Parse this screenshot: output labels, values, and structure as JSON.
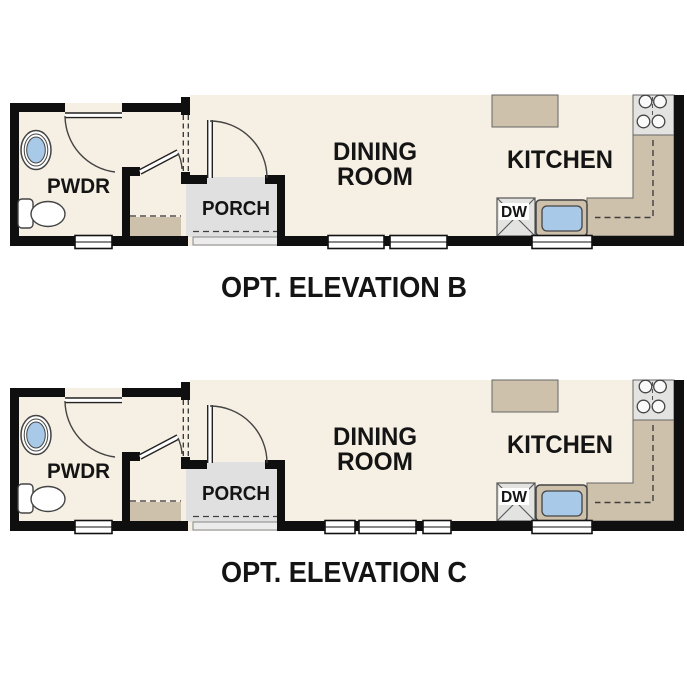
{
  "sheet": {
    "width": 687,
    "height": 687,
    "background": "#ffffff"
  },
  "colors": {
    "wall": "#0f0f0f",
    "floor": "#f6efe3",
    "casework_tan": "#cec1ab",
    "porch_gray": "#e0e0e0",
    "porch_step_gray": "#ececec",
    "appliance_gray": "#e3e3e2",
    "water_blue": "#a9c9e9",
    "thin_line": "#3f3f3f",
    "text": "#141414",
    "window_white": "#ffffff"
  },
  "plans": [
    {
      "caption": "OPT. ELEVATION B",
      "labels": {
        "powder": "PWDR",
        "porch": "PORCH",
        "dining1": "DINING",
        "dining2": "ROOM",
        "kitchen": "KITCHEN",
        "dishwasher": "DW"
      },
      "windows": {
        "powder": [
          {
            "x": 75,
            "w": 37
          }
        ],
        "dining": [
          {
            "x": 328,
            "w": 56
          },
          {
            "x": 390,
            "w": 57
          }
        ],
        "sink": [
          {
            "x": 532,
            "w": 60
          }
        ]
      }
    },
    {
      "caption": "OPT. ELEVATION C",
      "labels": {
        "powder": "PWDR",
        "porch": "PORCH",
        "dining1": "DINING",
        "dining2": "ROOM",
        "kitchen": "KITCHEN",
        "dishwasher": "DW"
      },
      "windows": {
        "powder": [
          {
            "x": 75,
            "w": 37
          }
        ],
        "dining": [
          {
            "x": 325,
            "w": 30
          },
          {
            "x": 359,
            "w": 57
          },
          {
            "x": 423,
            "w": 28
          }
        ],
        "sink": [
          {
            "x": 532,
            "w": 60
          }
        ]
      }
    }
  ],
  "icons": {
    "toilet": "toilet-icon",
    "vanity": "vanity-sink-icon",
    "kitchen_sink": "kitchen-sink-icon",
    "cooktop": "cooktop-burners-icon",
    "dishwasher": "dishwasher-icon",
    "door": "door-swing-icon",
    "window": "window-icon"
  }
}
